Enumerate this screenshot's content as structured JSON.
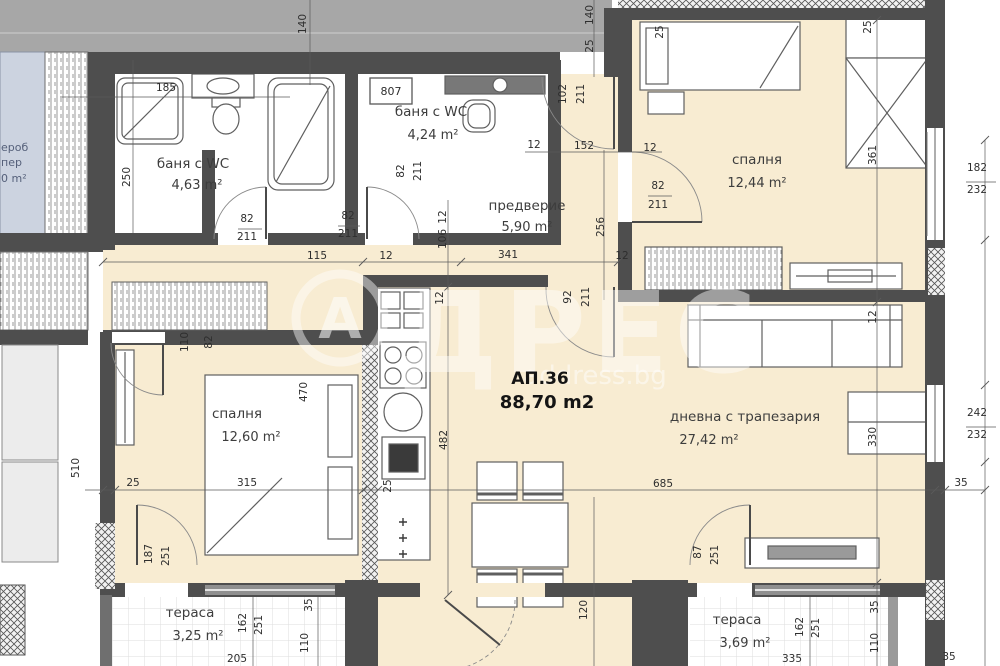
{
  "apartment": {
    "id": "АП.36",
    "area": "88,70 m2"
  },
  "watermark": {
    "logo_letter": "А",
    "brand_rest": "ДРЕС",
    "brand_full": "АДРЕС",
    "site": "address.bg"
  },
  "boiler_box_label": "807",
  "neighbor_fragments": [
    {
      "t": "ероб",
      "x": 1,
      "y": 151
    },
    {
      "t": "пер",
      "x": 1,
      "y": 166
    },
    {
      "t": "0 m²",
      "x": 1,
      "y": 182
    }
  ],
  "rooms": [
    {
      "name": "баня с WC",
      "area": "4,63 m²",
      "nx": 193,
      "ny": 168,
      "ax": 197,
      "ay": 189
    },
    {
      "name": "баня с WC",
      "area": "4,24 m²",
      "nx": 431,
      "ny": 116,
      "ax": 433,
      "ay": 139
    },
    {
      "name": "предверие",
      "area": "5,90 m²",
      "nx": 527,
      "ny": 210,
      "ax": 527,
      "ay": 231
    },
    {
      "name": "спалня",
      "area": "12,44 m²",
      "nx": 757,
      "ny": 164,
      "ax": 757,
      "ay": 187
    },
    {
      "name": "спалня",
      "area": "12,60 m²",
      "nx": 237,
      "ny": 418,
      "ax": 251,
      "ay": 441
    },
    {
      "name": "дневна с трапезария",
      "area": "27,42 m²",
      "nx": 745,
      "ny": 421,
      "ax": 709,
      "ay": 444
    },
    {
      "name": "тераса",
      "area": "3,25 m²",
      "nx": 190,
      "ny": 617,
      "ax": 198,
      "ay": 640
    },
    {
      "name": "тераса",
      "area": "3,69 m²",
      "nx": 737,
      "ny": 624,
      "ax": 745,
      "ay": 647
    }
  ],
  "dimensions": [
    {
      "t": "140",
      "x": 306,
      "y": 24,
      "r": -90
    },
    {
      "t": "185",
      "x": 166,
      "y": 91,
      "r": 0
    },
    {
      "t": "250",
      "x": 130,
      "y": 177,
      "r": -90
    },
    {
      "t": "82",
      "x": 247,
      "y": 222,
      "r": 0
    },
    {
      "t": "211",
      "x": 247,
      "y": 240,
      "r": 0
    },
    {
      "t": "82",
      "x": 348,
      "y": 219,
      "r": 0
    },
    {
      "t": "211",
      "x": 348,
      "y": 237,
      "r": 0
    },
    {
      "t": "82",
      "x": 404,
      "y": 171,
      "r": -90
    },
    {
      "t": "211",
      "x": 421,
      "y": 171,
      "r": -90
    },
    {
      "t": "102",
      "x": 566,
      "y": 94,
      "r": -90
    },
    {
      "t": "211",
      "x": 584,
      "y": 94,
      "r": -90
    },
    {
      "t": "140",
      "x": 593,
      "y": 15,
      "r": -90
    },
    {
      "t": "25",
      "x": 593,
      "y": 46,
      "r": -90
    },
    {
      "t": "12",
      "x": 534,
      "y": 148,
      "r": 0
    },
    {
      "t": "152",
      "x": 584,
      "y": 149,
      "r": 0
    },
    {
      "t": "12",
      "x": 650,
      "y": 151,
      "r": 0
    },
    {
      "t": "115",
      "x": 317,
      "y": 259,
      "r": 0
    },
    {
      "t": "12",
      "x": 386,
      "y": 259,
      "r": 0
    },
    {
      "t": "341",
      "x": 508,
      "y": 258,
      "r": 0
    },
    {
      "t": "12",
      "x": 446,
      "y": 217,
      "r": -90
    },
    {
      "t": "106",
      "x": 446,
      "y": 239,
      "r": -90
    },
    {
      "t": "256",
      "x": 604,
      "y": 227,
      "r": -90
    },
    {
      "t": "82",
      "x": 658,
      "y": 189,
      "r": 0
    },
    {
      "t": "211",
      "x": 658,
      "y": 208,
      "r": 0
    },
    {
      "t": "25",
      "x": 663,
      "y": 32,
      "r": -90
    },
    {
      "t": "25",
      "x": 871,
      "y": 27,
      "r": -90
    },
    {
      "t": "361",
      "x": 876,
      "y": 155,
      "r": -90
    },
    {
      "t": "182",
      "x": 977,
      "y": 171,
      "r": 0
    },
    {
      "t": "232",
      "x": 977,
      "y": 193,
      "r": 0
    },
    {
      "t": "12",
      "x": 876,
      "y": 317,
      "r": -90
    },
    {
      "t": "92",
      "x": 571,
      "y": 297,
      "r": -90
    },
    {
      "t": "211",
      "x": 589,
      "y": 297,
      "r": -90
    },
    {
      "t": "12",
      "x": 622,
      "y": 259,
      "r": 0
    },
    {
      "t": "110",
      "x": 188,
      "y": 342,
      "r": -90
    },
    {
      "t": "82",
      "x": 212,
      "y": 342,
      "r": -90
    },
    {
      "t": "470",
      "x": 307,
      "y": 392,
      "r": -90
    },
    {
      "t": "12",
      "x": 443,
      "y": 298,
      "r": -90
    },
    {
      "t": "482",
      "x": 447,
      "y": 440,
      "r": -90
    },
    {
      "t": "25",
      "x": 391,
      "y": 486,
      "r": -90
    },
    {
      "t": "25",
      "x": 133,
      "y": 486,
      "r": 0
    },
    {
      "t": "315",
      "x": 247,
      "y": 486,
      "r": 0
    },
    {
      "t": "685",
      "x": 663,
      "y": 487,
      "r": 0
    },
    {
      "t": "35",
      "x": 961,
      "y": 486,
      "r": 0
    },
    {
      "t": "242",
      "x": 977,
      "y": 416,
      "r": 0
    },
    {
      "t": "232",
      "x": 977,
      "y": 438,
      "r": 0
    },
    {
      "t": "330",
      "x": 876,
      "y": 437,
      "r": -90
    },
    {
      "t": "187",
      "x": 152,
      "y": 554,
      "r": -90
    },
    {
      "t": "251",
      "x": 169,
      "y": 556,
      "r": -90
    },
    {
      "t": "162",
      "x": 246,
      "y": 623,
      "r": -90
    },
    {
      "t": "251",
      "x": 262,
      "y": 625,
      "r": -90
    },
    {
      "t": "35",
      "x": 312,
      "y": 605,
      "r": -90
    },
    {
      "t": "110",
      "x": 308,
      "y": 643,
      "r": -90
    },
    {
      "t": "205",
      "x": 237,
      "y": 662,
      "r": 0
    },
    {
      "t": "120",
      "x": 587,
      "y": 610,
      "r": -90
    },
    {
      "t": "87",
      "x": 701,
      "y": 552,
      "r": -90
    },
    {
      "t": "251",
      "x": 718,
      "y": 555,
      "r": -90
    },
    {
      "t": "162",
      "x": 803,
      "y": 627,
      "r": -90
    },
    {
      "t": "251",
      "x": 819,
      "y": 628,
      "r": -90
    },
    {
      "t": "35",
      "x": 878,
      "y": 607,
      "r": -90
    },
    {
      "t": "110",
      "x": 878,
      "y": 643,
      "r": -90
    },
    {
      "t": "335",
      "x": 792,
      "y": 662,
      "r": 0
    },
    {
      "t": "35",
      "x": 949,
      "y": 660,
      "r": 0
    },
    {
      "t": "510",
      "x": 79,
      "y": 468,
      "r": -90
    }
  ],
  "colors": {
    "wall": "#4e4e4e",
    "room_fill": "#f8ecd2",
    "outside_grey": "#a7a7a7",
    "neighbor_fill": "#ccd3e0",
    "glazing": "#8f8f8f",
    "dim_text": "#2e2e2e"
  }
}
